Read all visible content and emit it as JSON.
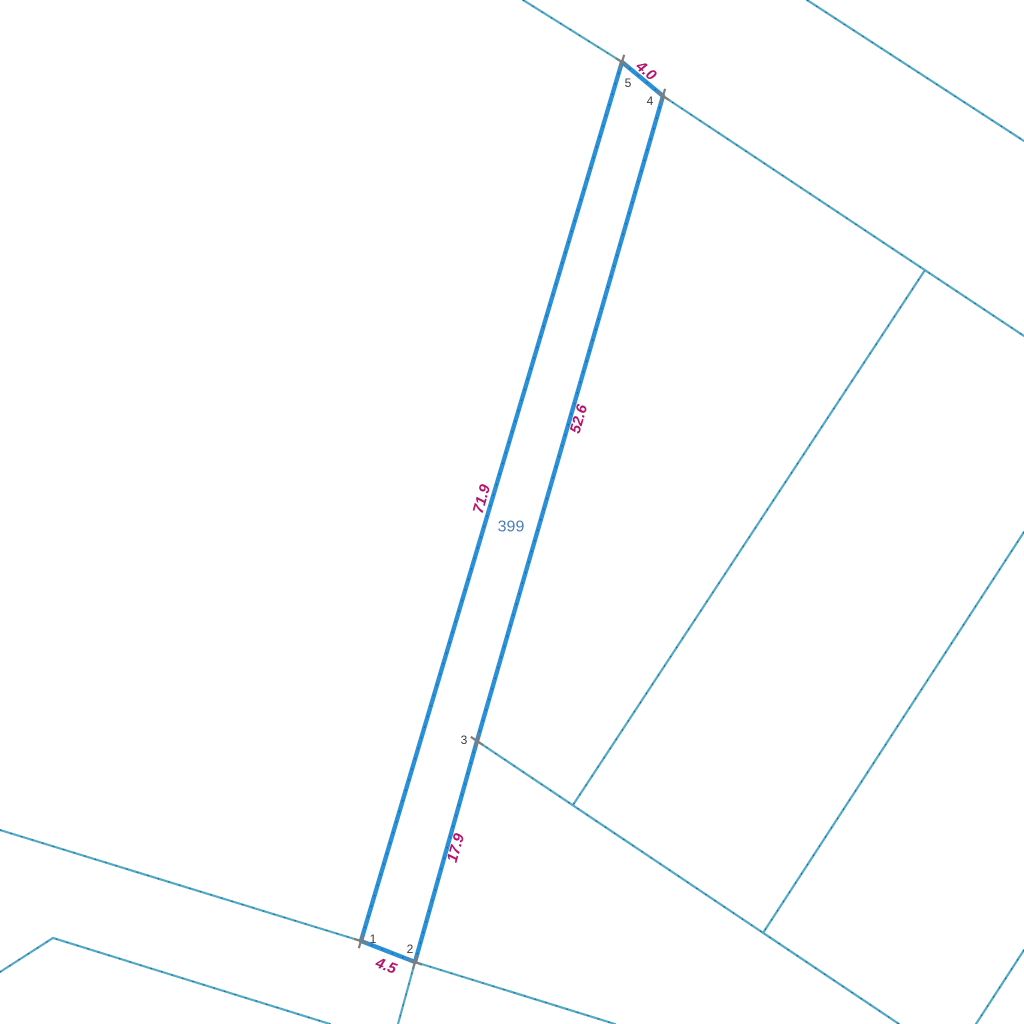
{
  "map": {
    "width": 1024,
    "height": 1024,
    "background": "#ffffff",
    "colors": {
      "parcel_stroke": "#2a90d8",
      "boundary_stroke": "#52aac6",
      "dash_overlay": "#1c4e74",
      "marker": "#7d7d7d",
      "measure_label": "#b3156b",
      "vertex_label": "#3c3c3c",
      "parcel_label": "#4a7db8"
    },
    "parcel": {
      "number": "399",
      "label_pos": {
        "x": 511,
        "y": 527
      },
      "vertices": [
        {
          "n": "1",
          "x": 361,
          "y": 941,
          "label_x": 373,
          "label_y": 939,
          "marker_angles": [
            17,
            -73
          ]
        },
        {
          "n": "2",
          "x": 415,
          "y": 962,
          "label_x": 410,
          "label_y": 949,
          "marker_angles": [
            21,
            -74
          ]
        },
        {
          "n": "3",
          "x": 477,
          "y": 741,
          "label_x": 464,
          "label_y": 740,
          "marker_angles": [
            34,
            -74
          ]
        },
        {
          "n": "4",
          "x": 663,
          "y": 96,
          "label_x": 650,
          "label_y": 101,
          "marker_angles": [
            34,
            -74
          ]
        },
        {
          "n": "5",
          "x": 622,
          "y": 62,
          "label_x": 628,
          "label_y": 83,
          "marker_angles": [
            32,
            -73
          ]
        }
      ],
      "edges": [
        {
          "from": "1",
          "to": "2",
          "length": "4.5",
          "label_x": 386,
          "label_y": 966,
          "angle": 21
        },
        {
          "from": "2",
          "to": "3",
          "length": "17.9",
          "label_x": 456,
          "label_y": 848,
          "angle": -74
        },
        {
          "from": "3",
          "to": "4",
          "length": "52.6",
          "label_x": 579,
          "label_y": 419,
          "angle": -74
        },
        {
          "from": "4",
          "to": "5",
          "length": "4.0",
          "label_x": 646,
          "label_y": 71,
          "angle": 40
        },
        {
          "from": "5",
          "to": "1",
          "length": "71.9",
          "label_x": 482,
          "label_y": 499,
          "angle": -74
        }
      ]
    },
    "boundary_lines": [
      {
        "id": "road-west-upper",
        "points": [
          [
            0,
            830
          ],
          [
            361,
            941
          ],
          [
            415,
            962
          ],
          [
            615,
            1024
          ]
        ]
      },
      {
        "id": "road-west-lower",
        "points": [
          [
            0,
            972
          ],
          [
            53,
            938
          ],
          [
            330,
            1024
          ]
        ]
      },
      {
        "id": "road-south-east",
        "points": [
          [
            477,
            741
          ],
          [
            899,
            1024
          ]
        ]
      },
      {
        "id": "lane-below-v2",
        "points": [
          [
            415,
            962
          ],
          [
            398,
            1024
          ]
        ]
      },
      {
        "id": "cross-line-upper",
        "points": [
          [
            925,
            270
          ],
          [
            573,
            805
          ]
        ]
      },
      {
        "id": "cross-line-lower",
        "points": [
          [
            1024,
            532
          ],
          [
            763,
            933
          ]
        ]
      },
      {
        "id": "road-north-west",
        "points": [
          [
            523,
            0
          ],
          [
            622,
            62
          ]
        ]
      },
      {
        "id": "road-north-east",
        "points": [
          [
            663,
            96
          ],
          [
            1024,
            336
          ]
        ]
      },
      {
        "id": "road-top-right",
        "points": [
          [
            807,
            0
          ],
          [
            1024,
            141
          ]
        ]
      },
      {
        "id": "corner-bottom-right",
        "points": [
          [
            1024,
            950
          ],
          [
            976,
            1024
          ]
        ]
      }
    ]
  }
}
